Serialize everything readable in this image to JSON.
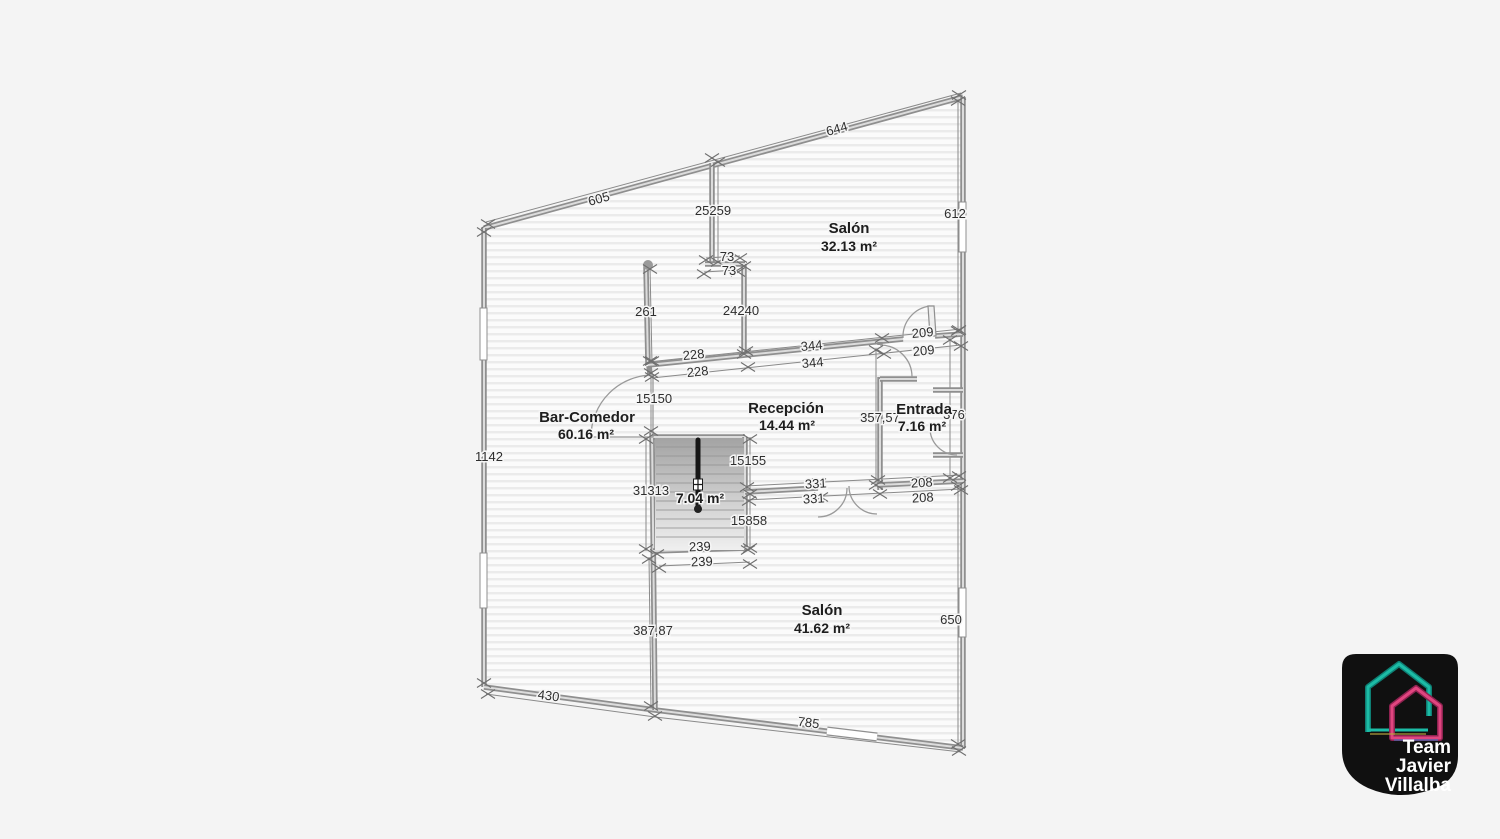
{
  "plan": {
    "rooms": [
      {
        "name": "Salón",
        "area": "32.13 m²"
      },
      {
        "name": "Bar-Comedor",
        "area": "60.16 m²"
      },
      {
        "name": "Recepción",
        "area": "14.44 m²"
      },
      {
        "name": "Entrada",
        "area": "7.16 m²"
      },
      {
        "name": "",
        "area": "7.04 m²"
      },
      {
        "name": "Salón",
        "area": "41.62 m²"
      }
    ],
    "dims": [
      "605",
      "644",
      "612",
      "25259",
      "73",
      "73",
      "24240",
      "261",
      "228",
      "228",
      "344",
      "344",
      "209",
      "209",
      "15150",
      "357,57",
      "376",
      "331",
      "331",
      "208",
      "208",
      "15155",
      "15858",
      "31313",
      "239",
      "239",
      "387,87",
      "430",
      "785",
      "650",
      "1142"
    ],
    "colors": {
      "background": "#f4f4f4",
      "wall": "#8f8f8f",
      "floor_stripe": "#ebebeb",
      "dimension_text": "#2e2e2e"
    }
  },
  "logo": {
    "lines": [
      "Team",
      "Javier",
      "Villalba"
    ],
    "badge_color": "#101010",
    "house_color_1": "#1cbca6",
    "house_color_2": "#e0457f",
    "text_color": "#ffffff"
  }
}
